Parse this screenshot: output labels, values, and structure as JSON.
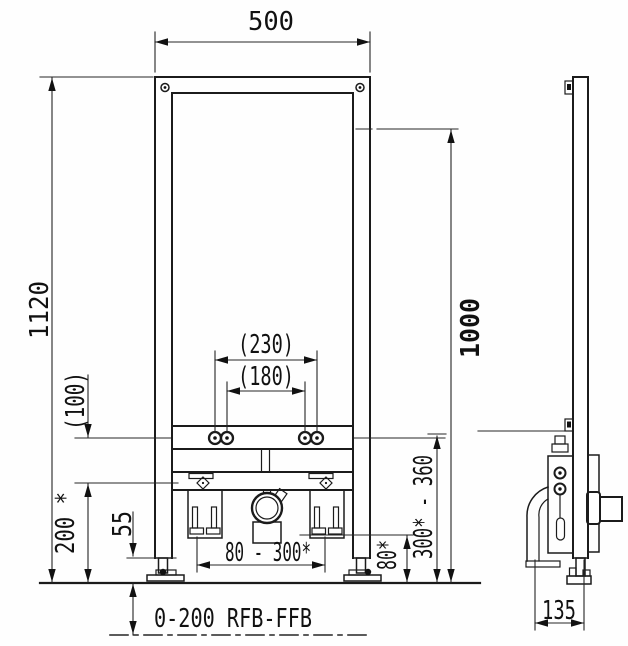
{
  "drawing": {
    "type": "installation-dimension-drawing",
    "colors": {
      "line": "#1b1b1b",
      "background": "#fefefe"
    },
    "front_view": {
      "dim_width_top": "500",
      "dim_height_overall": "1120",
      "dim_height_right": "1000",
      "dim_bolt_spacing_outer": "(230)",
      "dim_bolt_spacing_inner": "(180)",
      "dim_offset_left": "(100)",
      "dim_lower_left": "200 *",
      "dim_foot": "55",
      "dim_fixing_range": "80 - 300*",
      "dim_outlet_height": "80*",
      "dim_outlet_range": "300* - 360",
      "dim_floor_range": "0-200 RFB-FFB"
    },
    "side_view": {
      "dim_depth": "135"
    }
  }
}
